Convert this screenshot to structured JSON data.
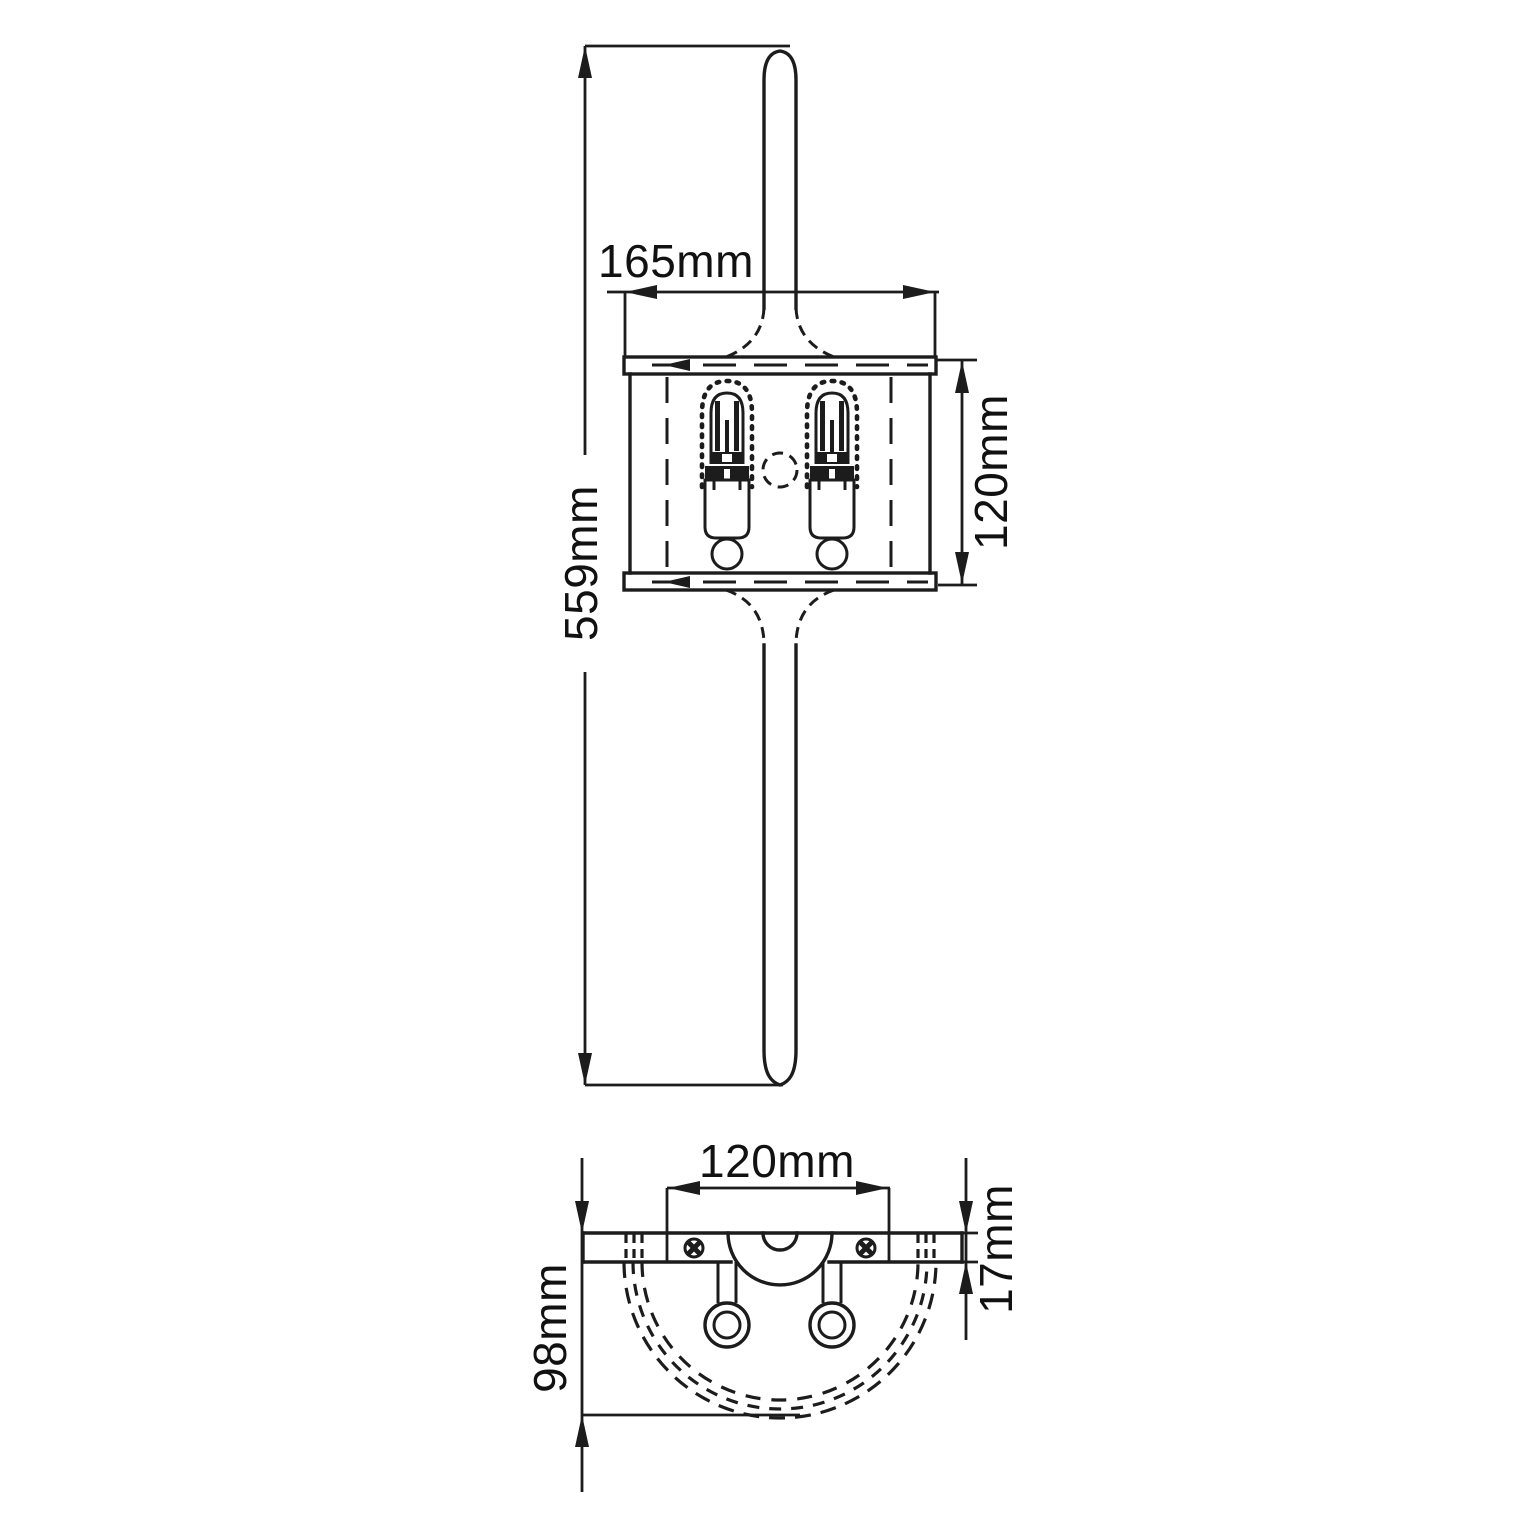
{
  "drawing": {
    "units": "mm",
    "colors": {
      "line": "#1c1c1c",
      "background": "#ffffff",
      "text": "#111111"
    },
    "front_view": {
      "overall_height": "559mm",
      "shade_width": "165mm",
      "shade_height": "120mm",
      "lamp_count": 2
    },
    "bottom_view": {
      "fixing_width": "120mm",
      "projection_depth": "98mm",
      "backplate_thickness": "17mm"
    }
  }
}
